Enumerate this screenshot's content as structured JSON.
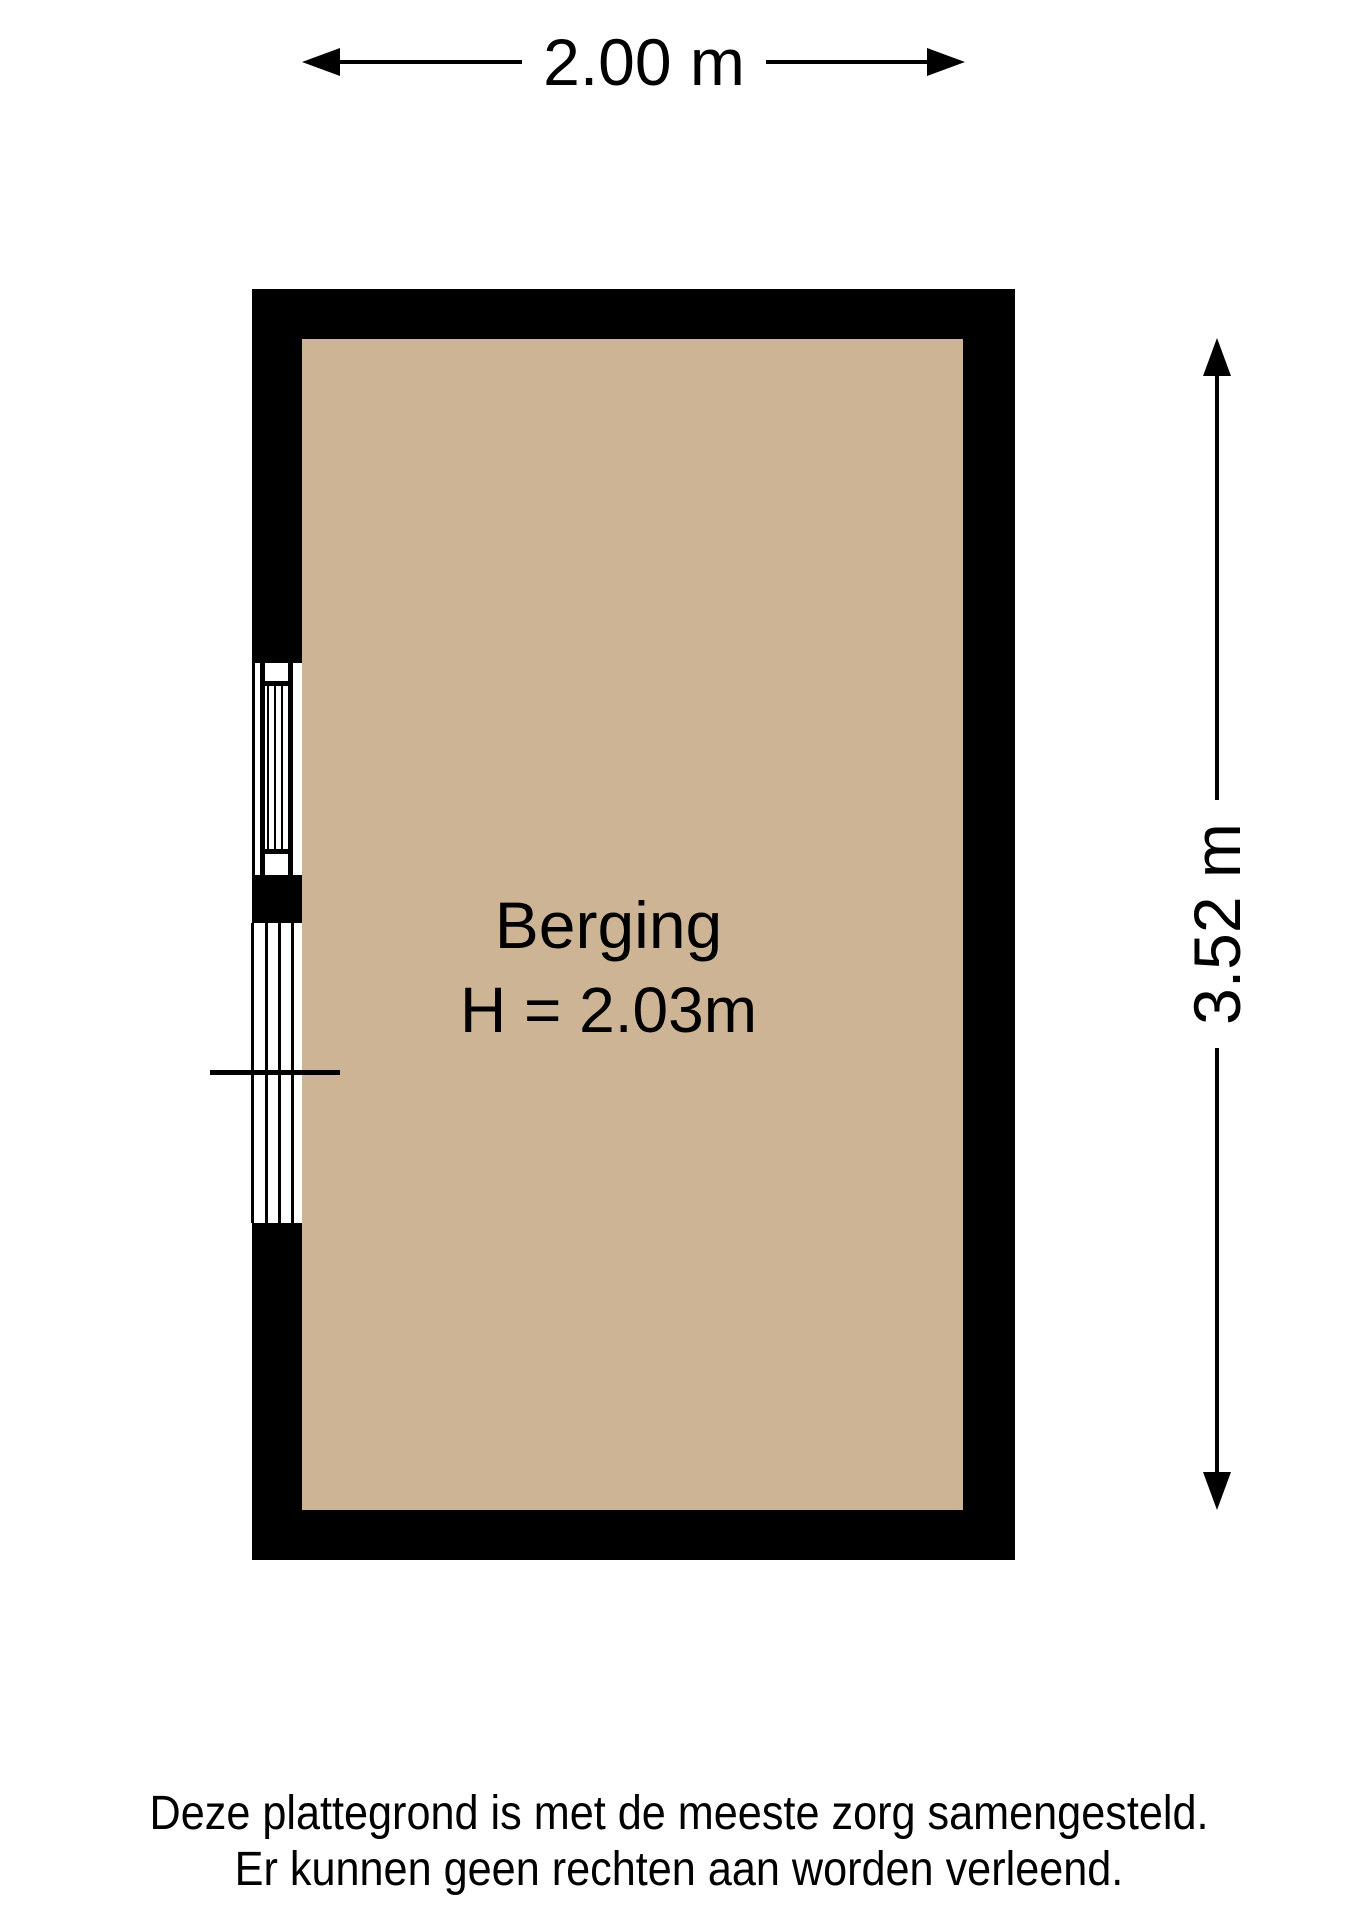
{
  "floorplan": {
    "background_color": "#ffffff",
    "dimensions": {
      "width_label": "2.00 m",
      "height_label": "3.52 m"
    },
    "room": {
      "name": "Berging",
      "ceiling_height_label": "H = 2.03m",
      "floor_color": "#cdb494",
      "wall_color": "#000000",
      "line_color": "#000000"
    },
    "footer": {
      "line1": "Deze plattegrond is met de meeste zorg samengesteld.",
      "line2": "Er kunnen geen rechten aan worden verleend."
    }
  }
}
